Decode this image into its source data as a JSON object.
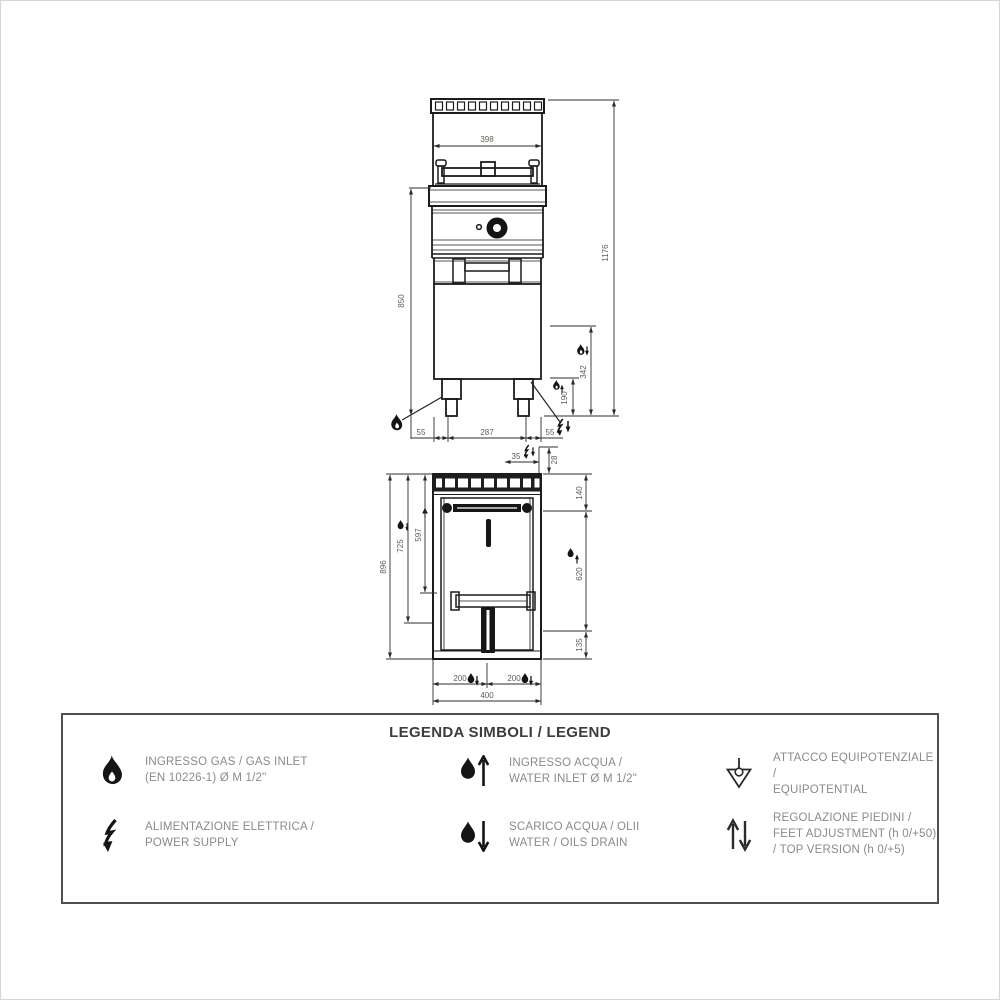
{
  "page": {
    "background": "#ffffff"
  },
  "front_view": {
    "dims": {
      "width_top": "398",
      "total_height": "1176",
      "worktop_height": "850",
      "gas_height_upper": "342",
      "gas_height_lower": "190",
      "foot_offset_left": "55",
      "feet_span": "287",
      "foot_offset_right": "55"
    }
  },
  "top_view": {
    "dims": {
      "total_depth": "896",
      "drain_depth": "725",
      "inner_depth": "597",
      "top_offset_x": "35",
      "top_offset_y": "28",
      "right_upper": "140",
      "right_middle": "620",
      "right_lower": "135",
      "drain_offset_left": "200",
      "drain_offset_right": "200",
      "total_width": "400"
    }
  },
  "legend": {
    "title": "LEGENDA SIMBOLI / LEGEND",
    "items": [
      {
        "icon": "gas-flame-icon",
        "lines": [
          "INGRESSO GAS / GAS INLET",
          "(EN 10226-1) Ø M 1/2\""
        ]
      },
      {
        "icon": "power-supply-icon",
        "lines": [
          "ALIMENTAZIONE ELETTRICA /",
          "POWER SUPPLY"
        ]
      },
      {
        "icon": "water-inlet-icon",
        "lines": [
          "INGRESSO ACQUA /",
          "WATER INLET Ø M 1/2\""
        ]
      },
      {
        "icon": "water-drain-icon",
        "lines": [
          "SCARICO ACQUA / OLII",
          "WATER / OILS DRAIN"
        ]
      },
      {
        "icon": "equipotential-icon",
        "lines": [
          "ATTACCO EQUIPOTENZIALE /",
          "EQUIPOTENTIAL"
        ]
      },
      {
        "icon": "feet-adjustment-icon",
        "lines": [
          "REGOLAZIONE PIEDINI  /",
          "FEET ADJUSTMENT (h 0/+50)",
          "/ TOP VERSION (h 0/+5)"
        ]
      }
    ]
  }
}
